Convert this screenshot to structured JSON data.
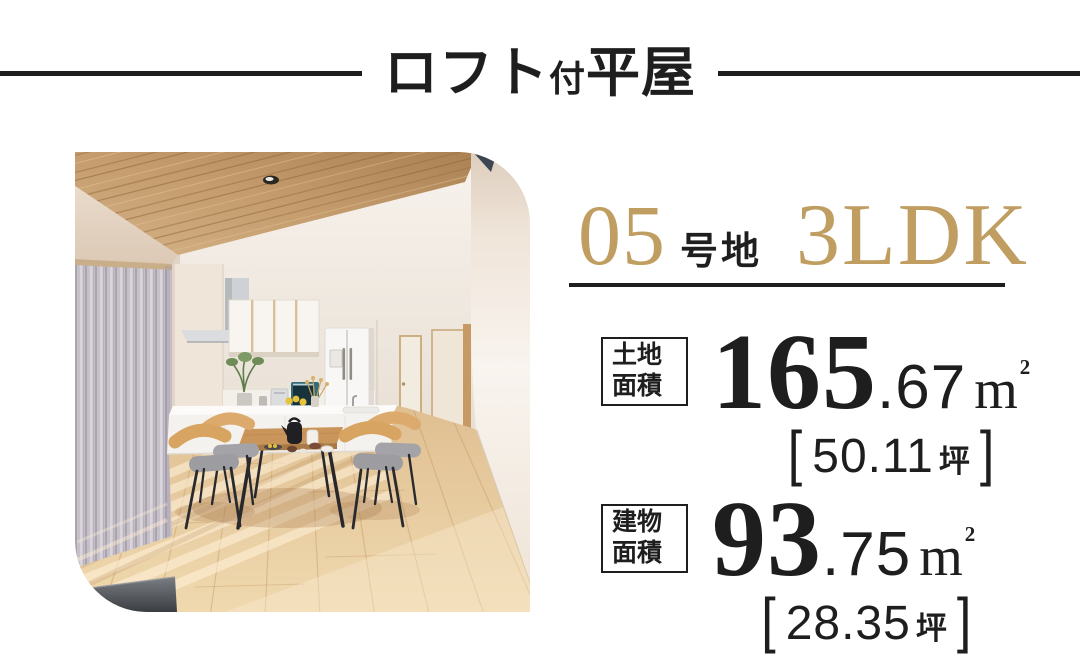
{
  "colors": {
    "accent_gold": "#C09D60",
    "ink": "#1E1E1E"
  },
  "header": {
    "title_main_1": "ロフト",
    "title_small": "付",
    "title_main_2": "平屋"
  },
  "listing": {
    "lot_number": "05",
    "lot_suffix": "号地",
    "layout": "3LDK",
    "areas": {
      "land": {
        "label_line1": "土地",
        "label_line2": "面積",
        "value_int": "165",
        "value_dec": ".67",
        "unit": "m",
        "unit_sup": "2",
        "bracket_open": "[",
        "tsubo_value": "50.11",
        "tsubo_unit": "坪",
        "bracket_close": "]"
      },
      "building": {
        "label_line1": "建物",
        "label_line2": "面積",
        "value_int": "93",
        "value_dec": ".75",
        "unit": "m",
        "unit_sup": "2",
        "bracket_open": "[",
        "tsubo_value": "28.35",
        "tsubo_unit": "坪",
        "bracket_close": "]"
      }
    }
  }
}
